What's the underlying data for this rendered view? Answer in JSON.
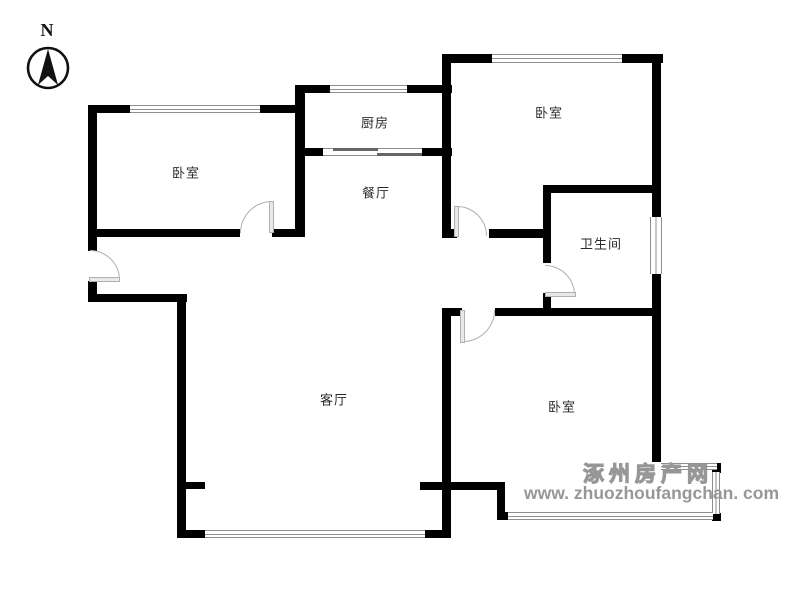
{
  "compass": {
    "label": "N",
    "icon": "compass-north-arrow-icon"
  },
  "rooms": {
    "bedroom_left": "卧室",
    "kitchen": "厨房",
    "dining": "餐厅",
    "bedroom_top_right": "卧室",
    "bathroom": "卫生间",
    "living": "客厅",
    "bedroom_bottom_right": "卧室"
  },
  "watermark": {
    "site_name": "涿州房产网",
    "site_url": "www. zhuozhoufangchan. com"
  },
  "colors": {
    "wall": "#000000",
    "window": "#8f8f8f",
    "door": "#b0b0b0",
    "label": "#2b2b2b",
    "watermark": "#979797"
  }
}
